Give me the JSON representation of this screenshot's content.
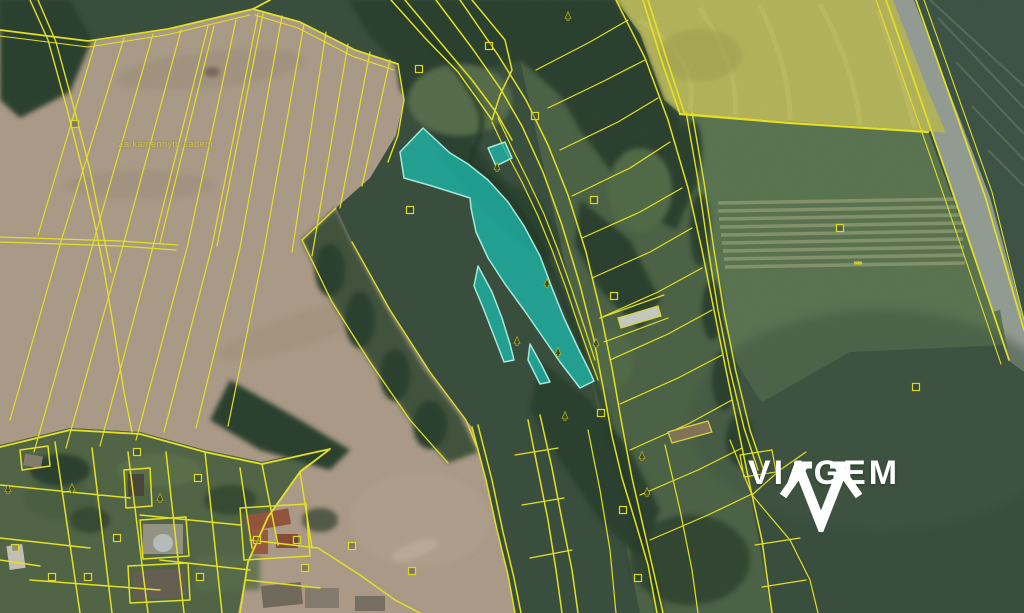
{
  "watermark": {
    "brand_name": "VIAGEM",
    "icon": "viagem-gem-icon",
    "text_color": "#ffffff"
  },
  "map_labels": {
    "field_name": "Za kamenným sadem"
  },
  "legend_colors": {
    "parcel_boundary": "#f1ee26",
    "selected_parcel_fill": "#1fc2b3",
    "selected_parcel_border": "#aef7e6",
    "road": "#9aa49b",
    "rapeseed_field": "#bcbc60",
    "plowed_field": "#b3a28e",
    "meadow": "#5f7a55",
    "forest": "#2e4431"
  },
  "map_symbols": [
    {
      "type": "square",
      "x": 75,
      "y": 124
    },
    {
      "type": "square",
      "x": 419,
      "y": 69
    },
    {
      "type": "square",
      "x": 489,
      "y": 46
    },
    {
      "type": "square",
      "x": 410,
      "y": 210
    },
    {
      "type": "square",
      "x": 535,
      "y": 116
    },
    {
      "type": "square",
      "x": 594,
      "y": 200
    },
    {
      "type": "square",
      "x": 614,
      "y": 296
    },
    {
      "type": "square",
      "x": 840,
      "y": 228
    },
    {
      "type": "square",
      "x": 916,
      "y": 387
    },
    {
      "type": "square",
      "x": 623,
      "y": 510
    },
    {
      "type": "square",
      "x": 638,
      "y": 578
    },
    {
      "type": "square",
      "x": 601,
      "y": 413
    },
    {
      "type": "square",
      "x": 137,
      "y": 452
    },
    {
      "type": "square",
      "x": 198,
      "y": 478
    },
    {
      "type": "square",
      "x": 15,
      "y": 548
    },
    {
      "type": "square",
      "x": 52,
      "y": 577
    },
    {
      "type": "square",
      "x": 88,
      "y": 577
    },
    {
      "type": "square",
      "x": 117,
      "y": 538
    },
    {
      "type": "square",
      "x": 200,
      "y": 577
    },
    {
      "type": "square",
      "x": 257,
      "y": 540
    },
    {
      "type": "square",
      "x": 297,
      "y": 540
    },
    {
      "type": "square",
      "x": 305,
      "y": 568
    },
    {
      "type": "square",
      "x": 352,
      "y": 546
    },
    {
      "type": "square",
      "x": 412,
      "y": 571
    },
    {
      "type": "tree",
      "x": 568,
      "y": 16
    },
    {
      "type": "tree",
      "x": 547,
      "y": 283
    },
    {
      "type": "tree",
      "x": 517,
      "y": 341
    },
    {
      "type": "tree",
      "x": 558,
      "y": 352
    },
    {
      "type": "tree",
      "x": 565,
      "y": 416
    },
    {
      "type": "tree",
      "x": 596,
      "y": 343
    },
    {
      "type": "tree",
      "x": 642,
      "y": 456
    },
    {
      "type": "tree",
      "x": 647,
      "y": 492
    },
    {
      "type": "tree",
      "x": 72,
      "y": 488
    },
    {
      "type": "tree",
      "x": 8,
      "y": 489
    },
    {
      "type": "tree",
      "x": 160,
      "y": 498
    },
    {
      "type": "tree",
      "x": 497,
      "y": 167
    },
    {
      "type": "dash",
      "x": 858,
      "y": 263
    }
  ]
}
